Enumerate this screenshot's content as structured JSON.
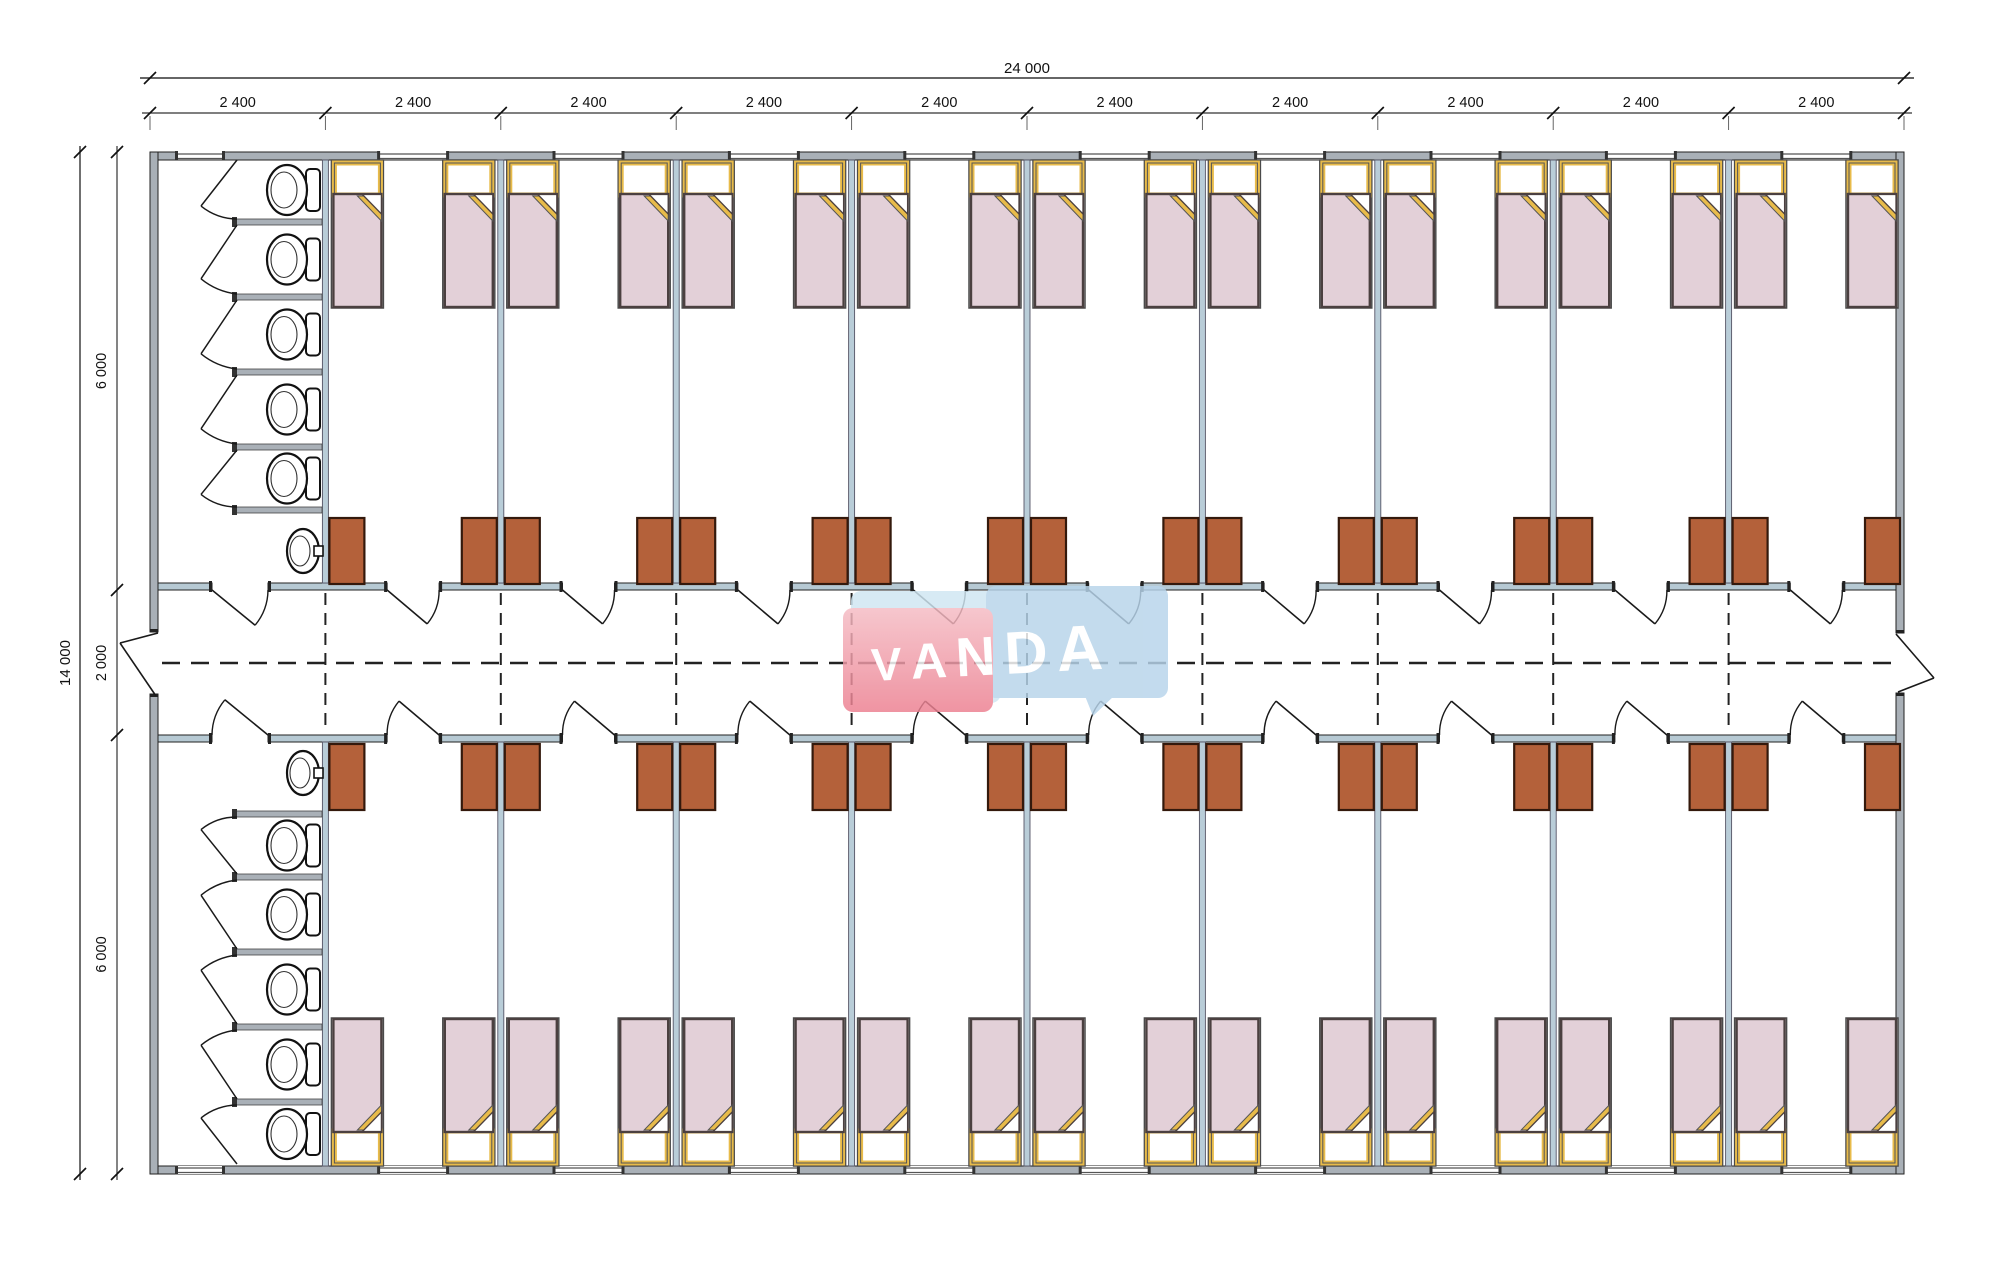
{
  "watermark": {
    "text": "VANDA",
    "pink": "#ec7f90",
    "pink_light": "#f5bcc4",
    "blue": "#b7d4ea",
    "blue_light": "#cfe6f2",
    "text_color": "#ffffff"
  },
  "dimensions": {
    "top_total": "24 000",
    "top_bays": [
      "2 400",
      "2 400",
      "2 400",
      "2 400",
      "2 400",
      "2 400",
      "2 400",
      "2 400",
      "2 400",
      "2 400"
    ],
    "left_total": "14 000",
    "left_segments": [
      "6 000",
      "2 000",
      "6 000"
    ]
  },
  "plan": {
    "building_mm": {
      "width": 24000,
      "height": 14000,
      "bay_width": 2400,
      "room_depth": 6000,
      "corridor_width": 2000
    },
    "counts": {
      "bays": 10,
      "rows": 2,
      "rooms_per_row": 9,
      "beds_per_room": 2,
      "wardrobes_per_room": 2,
      "toilet_stalls_per_row": 5,
      "washbasins_per_row": 1
    },
    "colors": {
      "outer_wall": "#a9b0b7",
      "partition": "#b9cdd8",
      "corridor_wall": "#b6c9d3",
      "stall_wall": "#a9b0b7",
      "wardrobe": "#b4613a",
      "wardrobe_border": "#34190c",
      "blanket": "#e3d0d8",
      "bed_border": "#4b4040",
      "headboard": "#e8bb4a",
      "fixture": "#ffffff",
      "line": "#1a1a1a",
      "dim_text": "#111111"
    }
  }
}
